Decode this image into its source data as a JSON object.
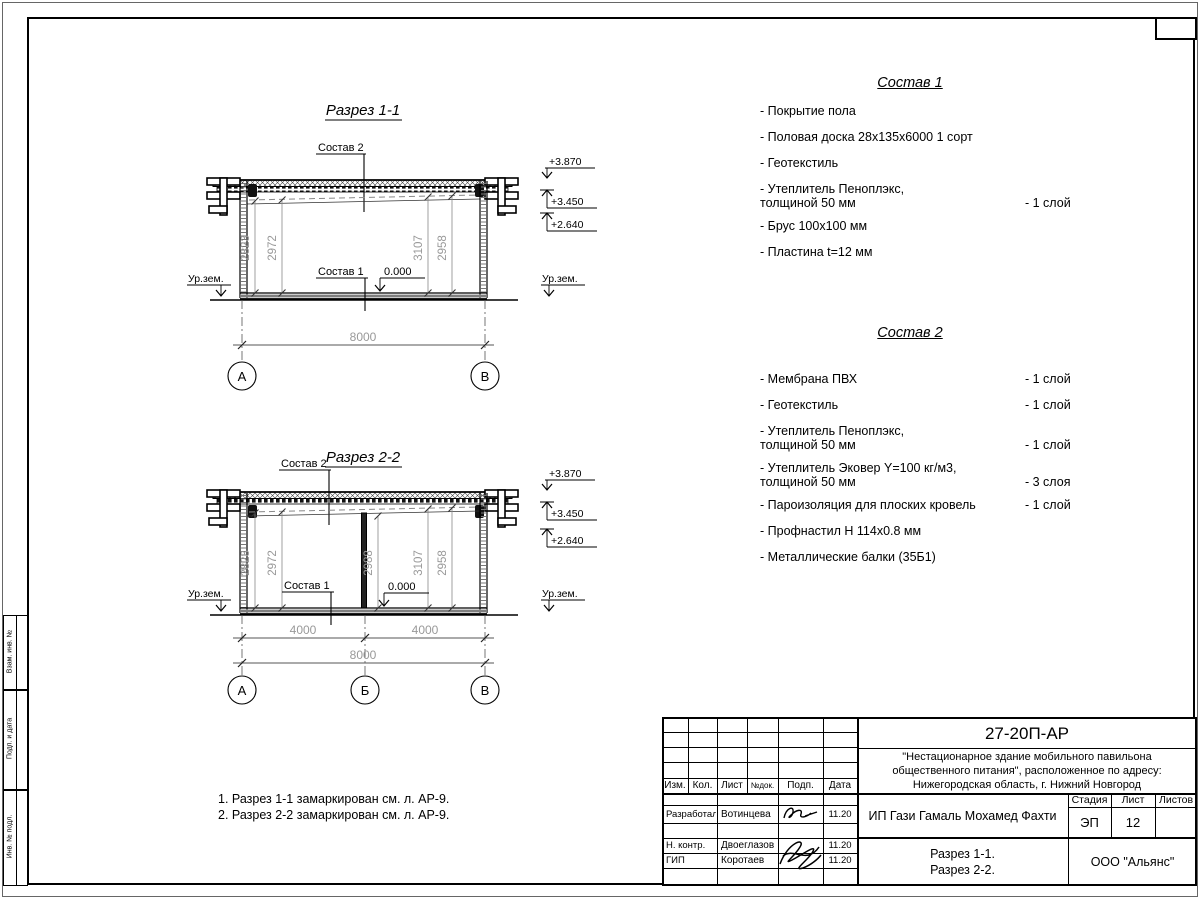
{
  "frame": {
    "side_label_1": "Взам. инв. №",
    "side_label_2": "Подп. и дата",
    "side_label_3": "Инв. № подл."
  },
  "section1": {
    "title": "Разрез 1-1",
    "roof_label": "Состав 2",
    "floor_label": "Состав 1",
    "zero_mark": "0.000",
    "level_top": "+3.870",
    "level_mid": "+3.450",
    "level_low": "+2.640",
    "ground_left": "Ур.зем.",
    "ground_right": "Ур.зем.",
    "dim_1": "2823",
    "dim_2": "2972",
    "dim_3": "3107",
    "dim_4": "2958",
    "dim_width": "8000",
    "axis_a": "А",
    "axis_b": "В"
  },
  "section2": {
    "title": "Разрез 2-2",
    "roof_label": "Состав 2",
    "floor_label": "Состав 1",
    "zero_mark": "0.000",
    "level_top": "+3.870",
    "level_mid": "+3.450",
    "level_low": "+2.640",
    "ground_left": "Ур.зем.",
    "ground_right": "Ур.зем.",
    "dim_1": "2823",
    "dim_2": "2972",
    "dim_3": "2988",
    "dim_4": "3107",
    "dim_5": "2958",
    "dim_left": "4000",
    "dim_right": "4000",
    "dim_total": "8000",
    "axis_a": "А",
    "axis_b": "Б",
    "axis_c": "В"
  },
  "sostav1": {
    "title": "Состав 1",
    "items": [
      {
        "name": "- Покрытие пола",
        "qty": ""
      },
      {
        "name": "- Половая доска 28х135х6000 1 сорт",
        "qty": ""
      },
      {
        "name": "- Геотекстиль",
        "qty": ""
      },
      {
        "name": "- Утеплитель Пеноплэкс,\nтолщиной 50 мм",
        "qty": "- 1 слой"
      },
      {
        "name": "- Брус 100х100 мм",
        "qty": ""
      },
      {
        "name": "- Пластина t=12 мм",
        "qty": ""
      }
    ]
  },
  "sostav2": {
    "title": "Состав 2",
    "items": [
      {
        "name": "- Мембрана ПВХ",
        "qty": "- 1 слой"
      },
      {
        "name": "- Геотекстиль",
        "qty": "- 1 слой"
      },
      {
        "name": "- Утеплитель Пеноплэкс,\nтолщиной 50 мм",
        "qty": "- 1 слой"
      },
      {
        "name": "- Утеплитель Эковер Y=100 кг/м3,\nтолщиной 50 мм",
        "qty": "- 3 слоя"
      },
      {
        "name": "- Пароизоляция для плоских кровель",
        "qty": "- 1 слой"
      },
      {
        "name": "- Профнастил Н 114х0.8 мм",
        "qty": ""
      },
      {
        "name": "- Металлические балки (35Б1)",
        "qty": ""
      }
    ]
  },
  "notes": {
    "line1": "1. Разрез 1-1 замаркирован см. л. АР-9.",
    "line2": "2. Разрез 2-2 замаркирован см. л. АР-9."
  },
  "titleblock": {
    "doc_number": "27-20П-АР",
    "project_name": "\"Нестационарное здание мобильного павильона\nобщественного питания\", расположенное по адресу:\nНижегородская область, г. Нижний Новгород",
    "client": "ИП Гази Гамаль Мохамед Фахти",
    "sheet_title": "Разрез 1-1.\nРазрез 2-2.",
    "company": "ООО \"Альянс\"",
    "stage_label": "Стадия",
    "stage_value": "ЭП",
    "sheet_label": "Лист",
    "sheet_value": "12",
    "sheets_label": "Листов",
    "col_izm": "Изм.",
    "col_kol": "Кол.",
    "col_list": "Лист",
    "col_ndok": "№док.",
    "col_podp": "Подп.",
    "col_data": "Дата",
    "row1_role": "Разработал",
    "row1_name": "Вотинцева",
    "row1_date": "11.20",
    "row2_role": "Н. контр.",
    "row2_name": "Двоеглазов",
    "row2_date": "11.20",
    "row3_role": "ГИП",
    "row3_name": "Коротаев",
    "row3_date": "11.20"
  }
}
